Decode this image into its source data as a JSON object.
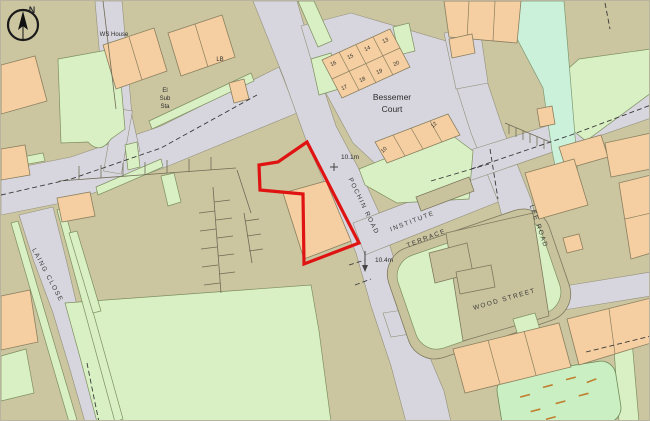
{
  "map": {
    "type": "site location plan",
    "compass": {
      "north_label": "N"
    },
    "labels": {
      "ws_house": "WS House",
      "lb": "LB",
      "el_sub_sta_1": "El",
      "el_sub_sta_2": "Sub",
      "el_sub_sta_3": "Sta",
      "bessemer_1": "Bessemer",
      "bessemer_2": "Court"
    },
    "roads": {
      "pochin": "POCHIN ROAD",
      "institute_1": "INSTITUTE",
      "institute_2": "TERRACE",
      "lee": "LEE ROAD",
      "wood": "WOOD STREET",
      "laing": "LAING CLOSE"
    },
    "spot_heights": {
      "h1": "10.1m",
      "h2": "10.4m"
    },
    "house_numbers": [
      "13",
      "14",
      "15",
      "16",
      "17",
      "18",
      "19",
      "20",
      "10",
      "12"
    ],
    "colors": {
      "background": "#cbc5a0",
      "road": "#d7d6de",
      "building": "#f5cfa1",
      "green_area": "#d8f0c3",
      "bright_green": "#c9efc3",
      "green_corridor": "#ccf1da",
      "plot_boundary_red": "#e01313",
      "text": "#2e2e2e"
    }
  }
}
